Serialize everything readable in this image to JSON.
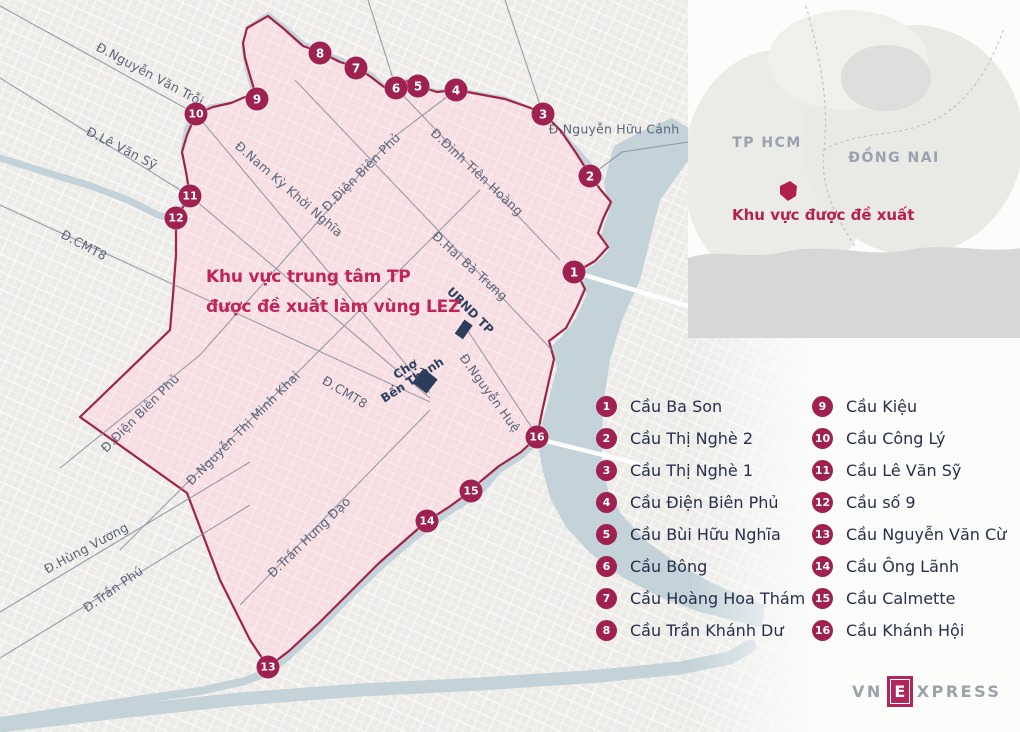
{
  "title": {
    "line1": "Khu vực trung tâm TP",
    "line2": "được đề xuất làm vùng LEZ"
  },
  "inset": {
    "region1": "TP HCM",
    "region2": "ĐỒNG NAI",
    "note": "Khu vực được đề xuất"
  },
  "map": {
    "streets": [
      {
        "text": "Đ.Nguyễn Văn Trỗi",
        "x": 150,
        "y": 74,
        "rot": 28
      },
      {
        "text": "Đ.Lê Văn Sỹ",
        "x": 122,
        "y": 148,
        "rot": 27
      },
      {
        "text": "Đ.CMT8",
        "x": 84,
        "y": 245,
        "rot": 28
      },
      {
        "text": "Đ.Nam Kỳ Khởi Nghĩa",
        "x": 289,
        "y": 189,
        "rot": 41
      },
      {
        "text": "Đ.Điện Biên Phủ",
        "x": 361,
        "y": 172,
        "rot": -45
      },
      {
        "text": "Đ.Đinh Tiên Hoàng",
        "x": 477,
        "y": 172,
        "rot": 43
      },
      {
        "text": "Đ.Nguyễn Hữu Cảnh",
        "x": 614,
        "y": 129,
        "rot": 0
      },
      {
        "text": "Đ.Hai Bà Trưng",
        "x": 470,
        "y": 266,
        "rot": 42
      },
      {
        "text": "Đ.Điện Biên Phủ",
        "x": 140,
        "y": 413,
        "rot": -45
      },
      {
        "text": "Đ.Nguyễn Thị Minh Khai",
        "x": 243,
        "y": 428,
        "rot": -45
      },
      {
        "text": "Đ.CMT8",
        "x": 345,
        "y": 392,
        "rot": 31
      },
      {
        "text": "Đ.Nguyễn Huệ",
        "x": 490,
        "y": 393,
        "rot": 54
      },
      {
        "text": "Đ.Hùng Vương",
        "x": 86,
        "y": 548,
        "rot": -28
      },
      {
        "text": "Đ.Trần Phú",
        "x": 113,
        "y": 589,
        "rot": -35
      },
      {
        "text": "Đ.Trần Hưng Đạo",
        "x": 309,
        "y": 537,
        "rot": -44
      }
    ],
    "landmarks": [
      {
        "lines": [
          "Chợ",
          "Bến Thành"
        ],
        "x": 409,
        "y": 375,
        "rot": -33
      },
      {
        "lines": [
          "UBND TP"
        ],
        "x": 470,
        "y": 311,
        "rot": 45
      }
    ],
    "markers": [
      {
        "num": "1",
        "x": 574,
        "y": 272
      },
      {
        "num": "2",
        "x": 590,
        "y": 176
      },
      {
        "num": "3",
        "x": 543,
        "y": 114
      },
      {
        "num": "4",
        "x": 456,
        "y": 90
      },
      {
        "num": "5",
        "x": 418,
        "y": 86
      },
      {
        "num": "6",
        "x": 396,
        "y": 88
      },
      {
        "num": "7",
        "x": 356,
        "y": 68
      },
      {
        "num": "8",
        "x": 320,
        "y": 53
      },
      {
        "num": "9",
        "x": 257,
        "y": 99
      },
      {
        "num": "10",
        "x": 196,
        "y": 114
      },
      {
        "num": "11",
        "x": 190,
        "y": 196
      },
      {
        "num": "12",
        "x": 176,
        "y": 218
      },
      {
        "num": "13",
        "x": 268,
        "y": 667
      },
      {
        "num": "14",
        "x": 427,
        "y": 521
      },
      {
        "num": "15",
        "x": 471,
        "y": 491
      },
      {
        "num": "16",
        "x": 537,
        "y": 437
      }
    ]
  },
  "legend": {
    "columns": [
      {
        "items": [
          {
            "num": "1",
            "label": "Cầu Ba Son"
          },
          {
            "num": "2",
            "label": "Cầu Thị Nghè 2"
          },
          {
            "num": "3",
            "label": "Cầu Thị Nghè 1"
          },
          {
            "num": "4",
            "label": "Cầu Điện Biên Phủ"
          },
          {
            "num": "5",
            "label": "Cầu Bùi Hữu Nghĩa"
          },
          {
            "num": "6",
            "label": "Cầu Bông"
          },
          {
            "num": "7",
            "label": "Cầu Hoàng Hoa Thám"
          },
          {
            "num": "8",
            "label": "Cầu Trần Khánh Dư"
          }
        ]
      },
      {
        "items": [
          {
            "num": "9",
            "label": "Cầu Kiệu"
          },
          {
            "num": "10",
            "label": "Cầu Công Lý"
          },
          {
            "num": "11",
            "label": "Cầu Lê Văn Sỹ"
          },
          {
            "num": "12",
            "label": "Cầu số 9"
          },
          {
            "num": "13",
            "label": "Cầu Nguyễn Văn Cừ"
          },
          {
            "num": "14",
            "label": "Cầu Ông Lãnh"
          },
          {
            "num": "15",
            "label": "Cầu Calmette"
          },
          {
            "num": "16",
            "label": "Cầu Khánh Hội"
          }
        ]
      }
    ]
  },
  "logo": {
    "vn": "VN",
    "e": "E",
    "xpress": "XPRESS"
  },
  "colors": {
    "zone_fill": "#f6dee2",
    "zone_border": "#a12348",
    "water": "#c3d3d9",
    "marker": "#9e2150",
    "title_red": "#c2245a",
    "legend_text": "#26304a",
    "street_text": "#5b6478",
    "inset_gray_label": "#9aa1af",
    "logo_gray": "#9ba2a8"
  }
}
